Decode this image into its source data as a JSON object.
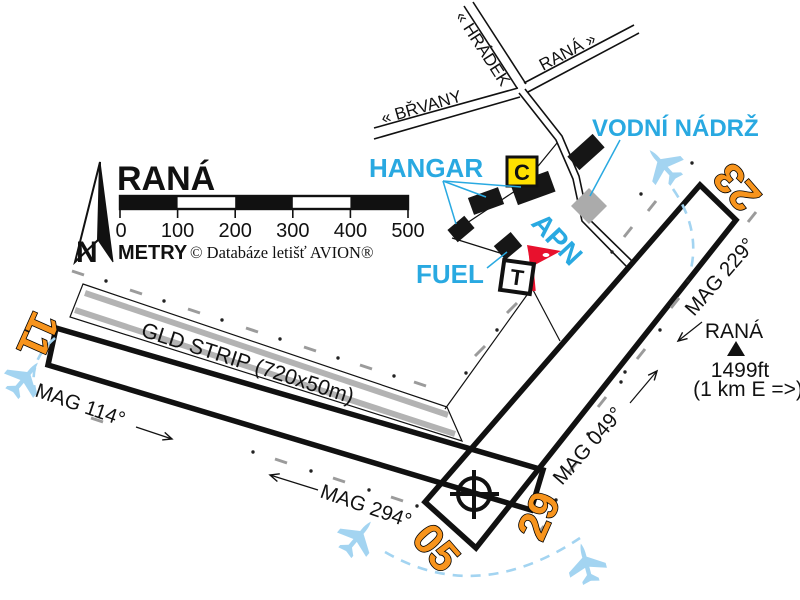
{
  "header": {
    "title": "RANÁ",
    "north_letter": "N",
    "scale": {
      "labels": [
        "0",
        "100",
        "200",
        "300",
        "400",
        "500"
      ],
      "unit": "METRY",
      "copyright": "© Databáze letišť AVION®"
    }
  },
  "roads": {
    "brvany": "« BŘVANY",
    "hradek": "« HRÁDEK",
    "rana": "RANÁ »"
  },
  "facilities": {
    "hangar": "HANGAR",
    "water_reservoir": "VODNÍ NÁDRŽ",
    "apron": "APN",
    "fuel": "FUEL",
    "c_sign": "C",
    "t_sign": "T"
  },
  "runways": {
    "gld_strip": "GLD STRIP (720x50m)",
    "designator_11": "11",
    "designator_29": "29",
    "designator_05": "05",
    "designator_23": "23",
    "mag_114": "MAG 114°",
    "mag_294": "MAG 294°",
    "mag_049": "MAG 049°",
    "mag_229": "MAG 229°"
  },
  "site": {
    "name": "RANÁ",
    "elevation": "1499ft",
    "distance": "(1 km E =>)"
  },
  "colors": {
    "label_cyan": "#29A9E1",
    "runway_orange": "#F7941D",
    "circuit_blue": "#A3D4F1",
    "strip_gray": "#B3B3B3",
    "water_gray": "#ABABAB",
    "sign_yellow": "#FFE000",
    "windsock_red": "#E8112D"
  }
}
